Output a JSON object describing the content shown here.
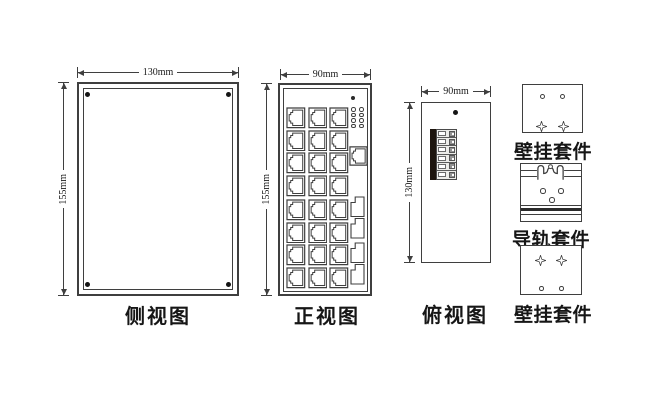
{
  "drawing_title": "industrial-switch-dimension-drawing",
  "colors": {
    "line": "#3f3f3f",
    "text": "#1a1a1a",
    "background": "#ffffff",
    "terminal_bar": "#1d150e",
    "screw": "#151515"
  },
  "views": {
    "side": {
      "label": "侧视图",
      "width_dim": "130mm",
      "height_dim": "155mm",
      "corner_screws": 4
    },
    "front": {
      "label": "正视图",
      "width_dim": "90mm",
      "height_dim": "155mm",
      "power_led": 1,
      "led_grid": {
        "rows": 4,
        "cols": 2
      },
      "rj45_top": {
        "rows": 4,
        "cols": 3
      },
      "rj45_bottom": {
        "rows": 4,
        "cols": 3
      },
      "console_ports": 1,
      "sfp_groups": [
        {
          "slots": 2
        },
        {
          "slots": 2
        }
      ]
    },
    "top": {
      "label": "俯视图",
      "width_dim": "90mm",
      "height_dim": "130mm",
      "ground_screws": 1,
      "terminal": {
        "positions": 6
      }
    },
    "accessories": [
      {
        "label": "壁挂套件",
        "style": "plate-screws-top"
      },
      {
        "label": "导轨套件",
        "style": "din-rail"
      },
      {
        "label": "壁挂套件",
        "style": "plate-screws-bottom"
      }
    ]
  }
}
